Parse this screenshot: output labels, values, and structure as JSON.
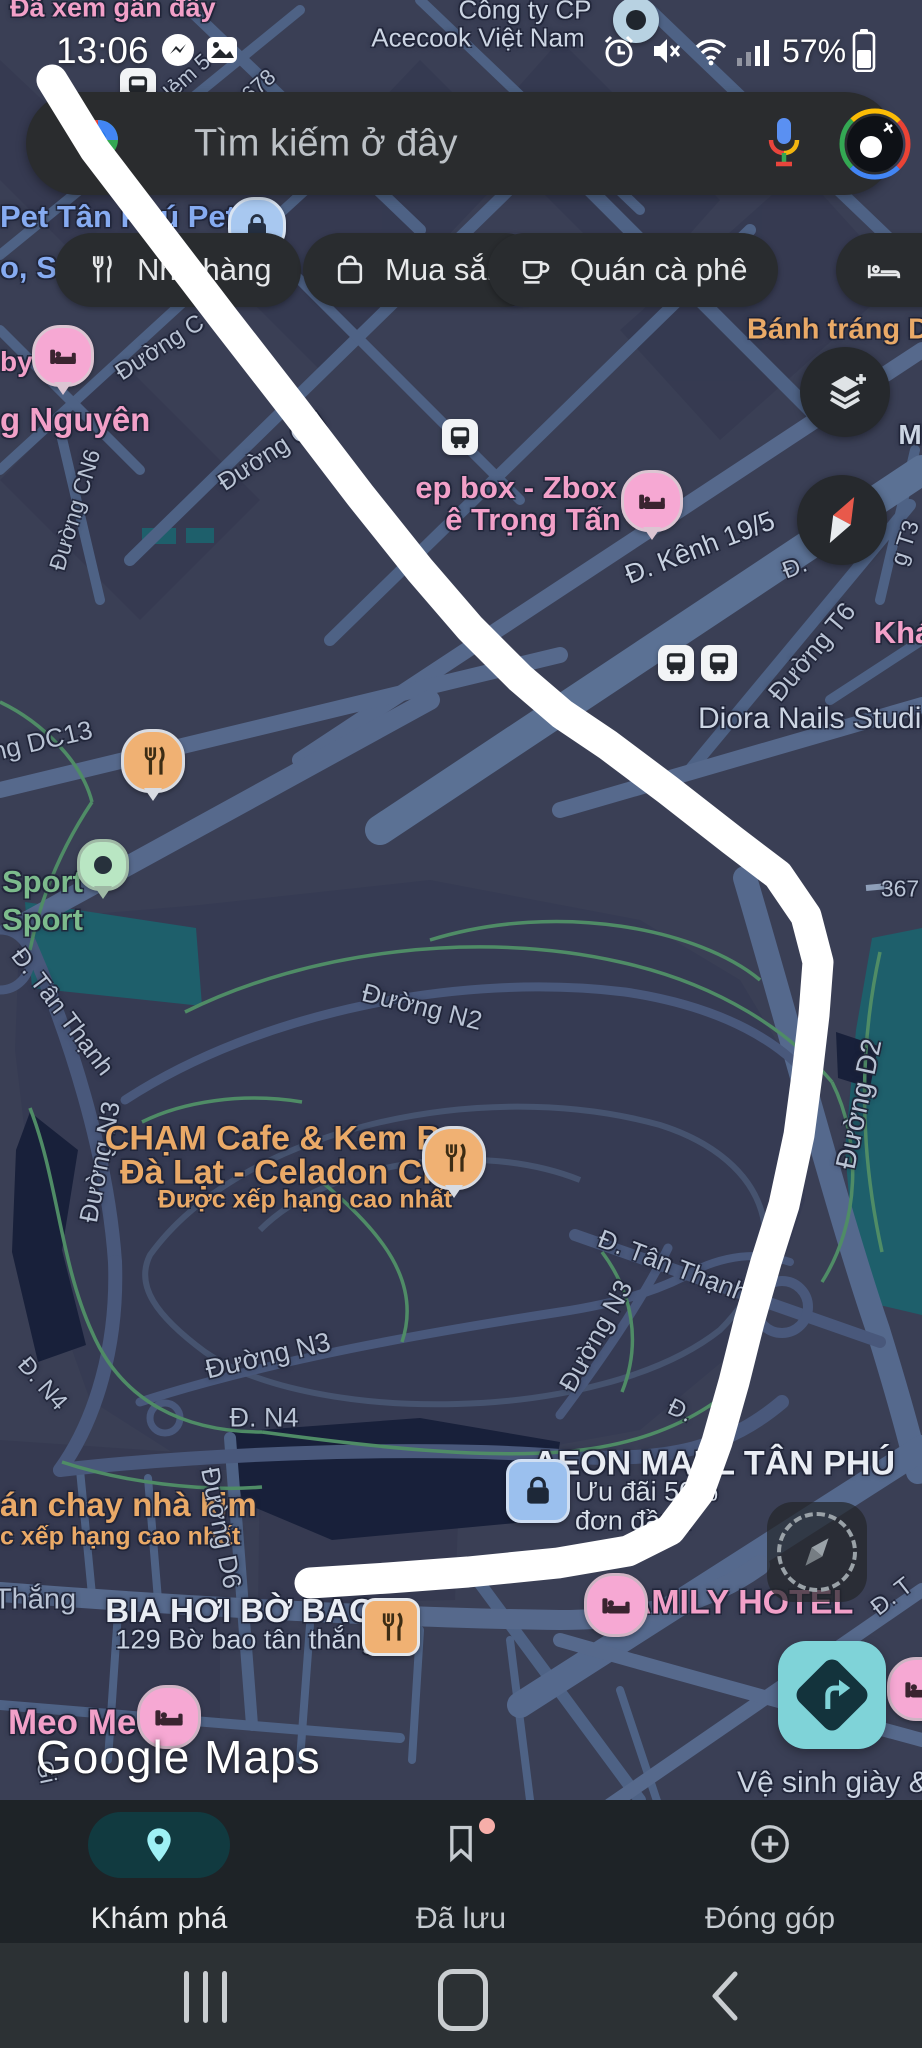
{
  "status_bar": {
    "time": "13:06",
    "battery_percent": "57%"
  },
  "search": {
    "placeholder": "Tìm kiếm ở đây"
  },
  "chips": [
    {
      "label": "Nhà hàng",
      "icon": "restaurant-icon"
    },
    {
      "label": "Mua sắm",
      "icon": "shopping-bag-icon"
    },
    {
      "label": "Quán cà phê",
      "icon": "coffee-icon"
    },
    {
      "label": "Kh",
      "icon": "bed-icon"
    }
  ],
  "watermark": "Google Maps",
  "bottom_nav": {
    "items": [
      {
        "label": "Khám phá",
        "icon": "location-pin-icon",
        "active": true
      },
      {
        "label": "Đã lưu",
        "icon": "bookmark-icon",
        "badge": true
      },
      {
        "label": "Đóng góp",
        "icon": "add-circle-icon"
      }
    ]
  },
  "map": {
    "colors": {
      "road": "#b9c3d4",
      "label": "#c7d1e0",
      "bright": "#e9edf4",
      "dim": "#ccd5e3",
      "soft": "#d8dfe9",
      "pink": "#f2a0c8",
      "orange": "#e9a967",
      "blue": "#86abf1",
      "green": "#7cbb8c",
      "accent_teal": "#7fd3d8",
      "route_white": "#ffffff"
    },
    "labels": [
      {
        "t": "Đã xem gần đây",
        "x": 10,
        "y": 8,
        "s": 27,
        "c": "pink",
        "w": 700,
        "a": "l"
      },
      {
        "t": "Công ty CP",
        "x": 525,
        "y": 10,
        "s": 26,
        "c": "dim"
      },
      {
        "t": "Acecook Việt Nam",
        "x": 478,
        "y": 38,
        "s": 26,
        "c": "dim"
      },
      {
        "t": "Pet Tân Phú Pet",
        "x": 0,
        "y": 217,
        "s": 31,
        "c": "blue",
        "w": 700,
        "a": "l"
      },
      {
        "t": "o, S",
        "x": 0,
        "y": 268,
        "s": 31,
        "c": "blue",
        "w": 700,
        "a": "l"
      },
      {
        "t": "by",
        "x": 0,
        "y": 362,
        "s": 28,
        "c": "pink",
        "w": 700,
        "a": "l"
      },
      {
        "t": "g Nguyên",
        "x": 0,
        "y": 420,
        "s": 33,
        "c": "pink",
        "w": 700,
        "a": "l"
      },
      {
        "t": "Hẻm 5",
        "x": 183,
        "y": 80,
        "r": -42,
        "s": 22,
        "c": "road"
      },
      {
        "t": "m678",
        "x": 252,
        "y": 92,
        "r": -42,
        "s": 22,
        "c": "road"
      },
      {
        "t": "Đường C",
        "x": 160,
        "y": 348,
        "r": -33,
        "s": 24,
        "c": "road"
      },
      {
        "t": "Đường CN",
        "x": 272,
        "y": 452,
        "r": -33,
        "s": 25,
        "c": "road"
      },
      {
        "t": "Đường CN6",
        "x": 75,
        "y": 510,
        "r": -73,
        "s": 23,
        "c": "road"
      },
      {
        "t": "Bánh tráng Dâ",
        "x": 747,
        "y": 330,
        "s": 29,
        "c": "orange",
        "w": 700,
        "a": "l"
      },
      {
        "t": "ep box - Zbox",
        "x": 516,
        "y": 488,
        "s": 31,
        "c": "pink",
        "w": 700
      },
      {
        "t": "ê Trọng Tấn",
        "x": 533,
        "y": 520,
        "s": 31,
        "c": "pink",
        "w": 700
      },
      {
        "t": "Đ. Kênh 19/5",
        "x": 700,
        "y": 548,
        "r": -21,
        "s": 27,
        "c": "label"
      },
      {
        "t": "Đ.",
        "x": 795,
        "y": 568,
        "r": -21,
        "s": 24,
        "c": "road"
      },
      {
        "t": "g T3",
        "x": 905,
        "y": 543,
        "r": -72,
        "s": 23,
        "c": "road"
      },
      {
        "t": "M",
        "x": 910,
        "y": 435,
        "s": 28,
        "c": "dim",
        "w": 700
      },
      {
        "t": "Đường T6",
        "x": 812,
        "y": 652,
        "r": -50,
        "s": 26,
        "c": "road"
      },
      {
        "t": "Khá",
        "x": 903,
        "y": 633,
        "s": 31,
        "c": "pink",
        "w": 700
      },
      {
        "t": "Diora Nails Studio",
        "x": 818,
        "y": 719,
        "s": 30,
        "c": "dim"
      },
      {
        "t": "367",
        "x": 900,
        "y": 889,
        "s": 23,
        "c": "road"
      },
      {
        "t": "ng DC13",
        "x": 42,
        "y": 741,
        "r": -13,
        "s": 26,
        "c": "road"
      },
      {
        "t": "Sport",
        "x": 2,
        "y": 882,
        "s": 31,
        "c": "green",
        "w": 700,
        "a": "l"
      },
      {
        "t": "Sport",
        "x": 2,
        "y": 920,
        "s": 31,
        "c": "green",
        "w": 700,
        "a": "l"
      },
      {
        "t": "Đ. Tân Thạnh",
        "x": 62,
        "y": 1012,
        "r": 53,
        "s": 25,
        "c": "road"
      },
      {
        "t": "Đường N2",
        "x": 422,
        "y": 1007,
        "r": 14,
        "s": 26,
        "c": "road"
      },
      {
        "t": "Đường N3",
        "x": 100,
        "y": 1162,
        "r": -79,
        "s": 26,
        "c": "road"
      },
      {
        "t": "CHẠM Cafe & Kem Bơ",
        "x": 285,
        "y": 1139,
        "s": 34,
        "c": "orange",
        "w": 700
      },
      {
        "t": "Đà Lạt - Celadon City",
        "x": 291,
        "y": 1173,
        "s": 34,
        "c": "orange",
        "w": 700
      },
      {
        "t": "Được xếp hạng cao nhất",
        "x": 305,
        "y": 1200,
        "s": 25,
        "c": "orange",
        "w": 700
      },
      {
        "t": "Đ. Tân Thạnh",
        "x": 673,
        "y": 1266,
        "r": 21,
        "s": 26,
        "c": "road"
      },
      {
        "t": "Đường N3",
        "x": 596,
        "y": 1336,
        "r": -61,
        "s": 26,
        "c": "road"
      },
      {
        "t": "Đường D2",
        "x": 859,
        "y": 1104,
        "r": -78,
        "s": 28,
        "c": "road"
      },
      {
        "t": "Đường N3",
        "x": 268,
        "y": 1356,
        "r": -13,
        "s": 27,
        "c": "road"
      },
      {
        "t": "Đ. N4",
        "x": 42,
        "y": 1384,
        "r": 49,
        "s": 24,
        "c": "road"
      },
      {
        "t": "Đ. N4",
        "x": 264,
        "y": 1418,
        "s": 27,
        "c": "road"
      },
      {
        "t": "Đ.",
        "x": 680,
        "y": 1411,
        "r": 25,
        "s": 24,
        "c": "road"
      },
      {
        "t": "AEON MALL TÂN PHÚ",
        "x": 714,
        "y": 1464,
        "s": 34,
        "c": "bright",
        "w": 700
      },
      {
        "t": "Ưu đãi 50%",
        "x": 575,
        "y": 1492,
        "s": 27,
        "c": "soft",
        "a": "l"
      },
      {
        "t": "đơn đầu t",
        "x": 575,
        "y": 1521,
        "s": 27,
        "c": "soft",
        "a": "l"
      },
      {
        "t": "án chay nhà kim",
        "x": 0,
        "y": 1505,
        "s": 33,
        "c": "orange",
        "w": 700,
        "a": "l"
      },
      {
        "t": "c xếp hạng cao nhất",
        "x": 0,
        "y": 1537,
        "s": 25,
        "c": "orange",
        "w": 700,
        "a": "l"
      },
      {
        "t": "Thắng",
        "x": 35,
        "y": 1600,
        "s": 29,
        "c": "road"
      },
      {
        "t": "Đường D6",
        "x": 221,
        "y": 1528,
        "r": 79,
        "s": 26,
        "c": "road"
      },
      {
        "t": "BIA HƠI BỜ BAO",
        "x": 240,
        "y": 1611,
        "s": 33,
        "c": "bright",
        "w": 700
      },
      {
        "t": "129 Bờ bao tân thắng",
        "x": 246,
        "y": 1640,
        "s": 27,
        "c": "dim"
      },
      {
        "t": "AMILY HOTEL",
        "x": 740,
        "y": 1603,
        "s": 34,
        "c": "pink",
        "w": 700
      },
      {
        "t": "Đ. T",
        "x": 892,
        "y": 1597,
        "r": -38,
        "s": 24,
        "c": "road"
      },
      {
        "t": "Meo Meo",
        "x": 8,
        "y": 1723,
        "s": 35,
        "c": "pink",
        "w": 700,
        "a": "l"
      },
      {
        "t": "Gi",
        "x": 46,
        "y": 1772,
        "r": 78,
        "s": 23,
        "c": "road"
      },
      {
        "t": "Vệ sinh giày & G",
        "x": 737,
        "y": 1783,
        "s": 30,
        "c": "dim",
        "a": "l"
      }
    ],
    "markers": [
      {
        "type": "bus",
        "x": 138,
        "y": 86,
        "name": "bus-stop-marker"
      },
      {
        "type": "shop-circle",
        "x": 254,
        "y": 223,
        "name": "pet-store-marker"
      },
      {
        "type": "company-dot",
        "x": 636,
        "y": 20,
        "name": "company-marker"
      },
      {
        "type": "hotel-pin",
        "x": 60,
        "y": 353,
        "name": "hotel-marker"
      },
      {
        "type": "bus",
        "x": 460,
        "y": 437,
        "name": "bus-stop-marker"
      },
      {
        "type": "hotel-pin",
        "x": 649,
        "y": 498,
        "name": "hotel-marker"
      },
      {
        "type": "bus",
        "x": 676,
        "y": 663,
        "name": "bus-stop-marker"
      },
      {
        "type": "bus",
        "x": 719,
        "y": 663,
        "name": "bus-stop-marker"
      },
      {
        "type": "restaurant-pin",
        "x": 150,
        "y": 758,
        "name": "restaurant-marker"
      },
      {
        "type": "green-dot",
        "x": 100,
        "y": 862,
        "name": "sport-marker"
      },
      {
        "type": "restaurant-pin",
        "x": 451,
        "y": 1155,
        "name": "restaurant-marker"
      },
      {
        "type": "shop-square",
        "x": 535,
        "y": 1488,
        "name": "mall-marker"
      },
      {
        "type": "restaurant-square",
        "x": 388,
        "y": 1624,
        "name": "restaurant-marker"
      },
      {
        "type": "hotel-dot",
        "x": 613,
        "y": 1602,
        "name": "hotel-marker"
      },
      {
        "type": "hotel-dot",
        "x": 166,
        "y": 1714,
        "name": "hotel-marker"
      },
      {
        "type": "hotel-dot",
        "x": 916,
        "y": 1686,
        "name": "hotel-marker"
      }
    ]
  }
}
